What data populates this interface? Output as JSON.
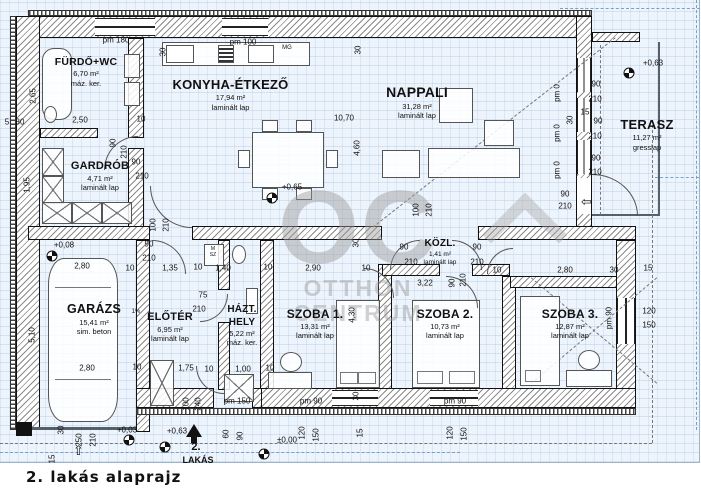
{
  "title": "2. lakás alaprajz",
  "unit": {
    "line1": "2.",
    "line2": "LAKÁS"
  },
  "watermark": {
    "line1": "OC",
    "line2": "OTTHON",
    "line3": "CENTRUM"
  },
  "colors": {
    "plan_bg": "#eef4fb",
    "grid": "#6ea0d7",
    "wall": "#111111",
    "watermark": "#9a9a9a",
    "blue_dash": "#7aa0c8"
  },
  "rooms": [
    {
      "id": "furdo",
      "name": "FÜRDŐ+WC",
      "area": "6,70 m²",
      "floor": "máz. ker."
    },
    {
      "id": "konyha",
      "name": "KONYHA-ÉTKEZŐ",
      "area": "17,94 m²",
      "floor": "laminált lap"
    },
    {
      "id": "nappali",
      "name": "NAPPALI",
      "area": "31,28 m²",
      "floor": "laminált lap"
    },
    {
      "id": "terasz",
      "name": "TERASZ",
      "area": "11,27 m²",
      "floor": "gresslap"
    },
    {
      "id": "gardrob",
      "name": "GARDRÓB",
      "area": "4,71 m²",
      "floor": "laminált lap"
    },
    {
      "id": "garazs",
      "name": "GARÁZS",
      "area": "15,41 m²",
      "floor": "sim. beton"
    },
    {
      "id": "eloter",
      "name": "ELŐTÉR",
      "area": "6,95 m²",
      "floor": "laminált lap"
    },
    {
      "id": "hazthely",
      "name": "HÁZT. HELY",
      "name_l1": "HÁZT.",
      "name_l2": "HELY",
      "area": "5,22 m²",
      "floor": "máz. ker."
    },
    {
      "id": "szoba1",
      "name": "SZOBA 1.",
      "area": "13,31 m²",
      "floor": "laminált lap"
    },
    {
      "id": "kozl",
      "name": "KÖZL.",
      "area": "1,41 m²",
      "floor": "laminált lap"
    },
    {
      "id": "szoba2",
      "name": "SZOBA 2.",
      "area": "10,73 m²",
      "floor": "laminált lap"
    },
    {
      "id": "szoba3",
      "name": "SZOBA 3.",
      "area": "12,87 m²",
      "floor": "laminált lap"
    }
  ],
  "level_markers": [
    {
      "x": 272,
      "y": 198
    },
    {
      "x": 629,
      "y": 73
    },
    {
      "x": 52,
      "y": 256
    },
    {
      "x": 129,
      "y": 440
    },
    {
      "x": 165,
      "y": 447
    },
    {
      "x": 264,
      "y": 454
    }
  ],
  "annotations": [
    {
      "t": "pm 180",
      "x": 116,
      "y": 40
    },
    {
      "t": "pm 100",
      "x": 243,
      "y": 42
    },
    {
      "t": "MG",
      "x": 287,
      "y": 48,
      "s": 6
    },
    {
      "t": "30",
      "x": 163,
      "y": 52,
      "r": 1
    },
    {
      "t": "30",
      "x": 358,
      "y": 50,
      "r": 1
    },
    {
      "t": "2,65",
      "x": 33,
      "y": 96,
      "r": 1
    },
    {
      "t": "5",
      "x": 7,
      "y": 122
    },
    {
      "t": "30",
      "x": 20,
      "y": 122
    },
    {
      "t": "2,50",
      "x": 80,
      "y": 120
    },
    {
      "t": "10",
      "x": 141,
      "y": 119
    },
    {
      "t": "90",
      "x": 113,
      "y": 143,
      "r": 1
    },
    {
      "t": "210",
      "x": 124,
      "y": 152,
      "r": 1
    },
    {
      "t": "90",
      "x": 136,
      "y": 162
    },
    {
      "t": "210",
      "x": 142,
      "y": 176
    },
    {
      "t": "1,95",
      "x": 27,
      "y": 185,
      "r": 1
    },
    {
      "t": "10,70",
      "x": 344,
      "y": 118
    },
    {
      "t": "4,60",
      "x": 357,
      "y": 148,
      "r": 1
    },
    {
      "t": "+0,65",
      "x": 292,
      "y": 187
    },
    {
      "t": "+0,63",
      "x": 653,
      "y": 63
    },
    {
      "t": "pm 0",
      "x": 557,
      "y": 93,
      "r": 1
    },
    {
      "t": "90",
      "x": 596,
      "y": 84
    },
    {
      "t": "210",
      "x": 595,
      "y": 99
    },
    {
      "t": "30",
      "x": 570,
      "y": 120,
      "r": 1
    },
    {
      "t": "15",
      "x": 585,
      "y": 112
    },
    {
      "t": "90",
      "x": 598,
      "y": 121
    },
    {
      "t": "pm 0",
      "x": 557,
      "y": 133,
      "r": 1
    },
    {
      "t": "210",
      "x": 595,
      "y": 136
    },
    {
      "t": "pm 0",
      "x": 557,
      "y": 170,
      "r": 1
    },
    {
      "t": "90",
      "x": 596,
      "y": 158
    },
    {
      "t": "210",
      "x": 595,
      "y": 172
    },
    {
      "t": "90",
      "x": 565,
      "y": 194
    },
    {
      "t": "210",
      "x": 565,
      "y": 206
    },
    {
      "t": "100",
      "x": 153,
      "y": 225,
      "r": 1
    },
    {
      "t": "210",
      "x": 166,
      "y": 225,
      "r": 1
    },
    {
      "t": "90",
      "x": 149,
      "y": 244
    },
    {
      "t": "210",
      "x": 149,
      "y": 258
    },
    {
      "t": "+0,08",
      "x": 64,
      "y": 245
    },
    {
      "t": "2,80",
      "x": 82,
      "y": 266
    },
    {
      "t": "10",
      "x": 130,
      "y": 268
    },
    {
      "t": "1,35",
      "x": 170,
      "y": 268
    },
    {
      "t": "10",
      "x": 198,
      "y": 267
    },
    {
      "t": "1,40",
      "x": 223,
      "y": 268
    },
    {
      "t": "10",
      "x": 268,
      "y": 267
    },
    {
      "t": "M",
      "x": 213,
      "y": 249,
      "s": 5
    },
    {
      "t": "SZ",
      "x": 213,
      "y": 255,
      "s": 5
    },
    {
      "t": "2,90",
      "x": 313,
      "y": 268
    },
    {
      "t": "10",
      "x": 366,
      "y": 268
    },
    {
      "t": "30",
      "x": 356,
      "y": 243,
      "r": 1
    },
    {
      "t": "100",
      "x": 416,
      "y": 210,
      "r": 1
    },
    {
      "t": "210",
      "x": 429,
      "y": 210,
      "r": 1
    },
    {
      "t": "90",
      "x": 404,
      "y": 247
    },
    {
      "t": "210",
      "x": 411,
      "y": 262
    },
    {
      "t": "90",
      "x": 477,
      "y": 247
    },
    {
      "t": "210",
      "x": 477,
      "y": 262
    },
    {
      "t": "10",
      "x": 497,
      "y": 270
    },
    {
      "t": "3,22",
      "x": 425,
      "y": 283
    },
    {
      "t": "90",
      "x": 452,
      "y": 283,
      "r": 1
    },
    {
      "t": "210",
      "x": 463,
      "y": 280,
      "r": 1
    },
    {
      "t": "2,80",
      "x": 565,
      "y": 270
    },
    {
      "t": "30",
      "x": 614,
      "y": 270
    },
    {
      "t": "15",
      "x": 648,
      "y": 268
    },
    {
      "t": "4,30",
      "x": 352,
      "y": 315,
      "r": 1
    },
    {
      "t": "30",
      "x": 356,
      "y": 396,
      "r": 1
    },
    {
      "t": "75",
      "x": 203,
      "y": 295
    },
    {
      "t": "210",
      "x": 199,
      "y": 309
    },
    {
      "t": "5,10",
      "x": 32,
      "y": 335,
      "r": 1
    },
    {
      "t": "1%",
      "x": 136,
      "y": 312,
      "s": 6
    },
    {
      "t": "2,80",
      "x": 87,
      "y": 368
    },
    {
      "t": "10",
      "x": 137,
      "y": 367
    },
    {
      "t": "1,75",
      "x": 186,
      "y": 368
    },
    {
      "t": "10",
      "x": 209,
      "y": 369
    },
    {
      "t": "1,00",
      "x": 243,
      "y": 369
    },
    {
      "t": "10",
      "x": 270,
      "y": 368
    },
    {
      "t": "pm 150",
      "x": 237,
      "y": 401
    },
    {
      "t": "pm 90",
      "x": 311,
      "y": 401
    },
    {
      "t": "pm 90",
      "x": 455,
      "y": 401
    },
    {
      "t": "pm 90",
      "x": 609,
      "y": 318,
      "r": 1
    },
    {
      "t": "120",
      "x": 649,
      "y": 311
    },
    {
      "t": "150",
      "x": 649,
      "y": 325
    },
    {
      "t": "100",
      "x": 186,
      "y": 404,
      "r": 1
    },
    {
      "t": "240",
      "x": 198,
      "y": 404,
      "r": 1
    },
    {
      "t": "30",
      "x": 61,
      "y": 430,
      "r": 1
    },
    {
      "t": "250",
      "x": 79,
      "y": 440,
      "r": 1
    },
    {
      "t": "210",
      "x": 93,
      "y": 440,
      "r": 1
    },
    {
      "t": "+0,03",
      "x": 127,
      "y": 430
    },
    {
      "t": "+0,63",
      "x": 177,
      "y": 431
    },
    {
      "t": "±0,00",
      "x": 287,
      "y": 440
    },
    {
      "t": "60",
      "x": 226,
      "y": 434,
      "r": 1
    },
    {
      "t": "90",
      "x": 240,
      "y": 436,
      "r": 1
    },
    {
      "t": "120",
      "x": 302,
      "y": 433,
      "r": 1
    },
    {
      "t": "150",
      "x": 316,
      "y": 435,
      "r": 1
    },
    {
      "t": "15",
      "x": 360,
      "y": 433,
      "r": 1
    },
    {
      "t": "120",
      "x": 450,
      "y": 433,
      "r": 1
    },
    {
      "t": "150",
      "x": 464,
      "y": 434,
      "r": 1
    },
    {
      "t": "15",
      "x": 52,
      "y": 459,
      "r": 1
    }
  ]
}
